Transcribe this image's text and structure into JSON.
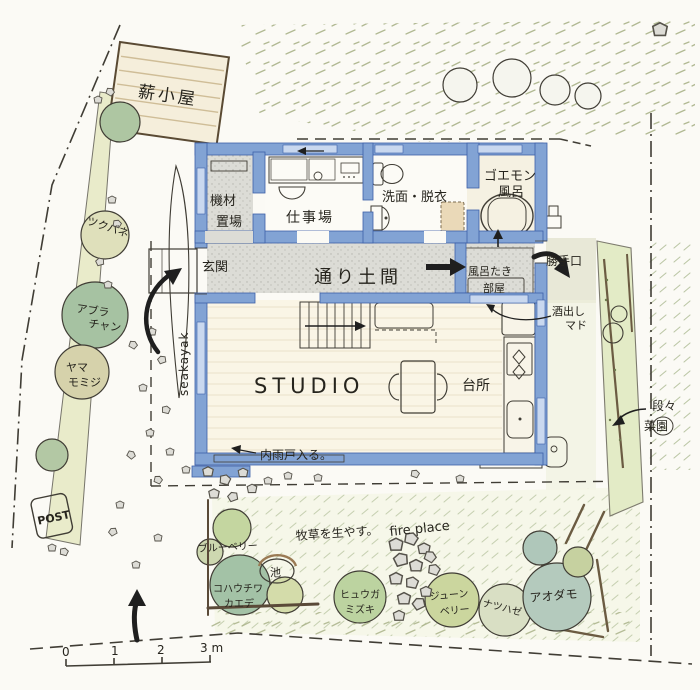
{
  "building": {
    "woodshed": "薪小屋",
    "equipment_room": {
      "l1": "機材",
      "l2": "置場"
    },
    "workshop": "仕事場",
    "washroom": "洗面・脱衣",
    "goemon_bath": {
      "l1": "ゴエモン",
      "l2": "風呂"
    },
    "entrance": "玄関",
    "doma_corridor": "通り土間",
    "bath_boiler_room": {
      "l1": "風呂たき",
      "l2": "部屋"
    },
    "back_door": "勝手口",
    "sake_window": {
      "l1": "酒出し",
      "l2": "マド"
    },
    "studio": "STUDIO",
    "kitchen": "台所",
    "inner_shutter_note": "内雨戸入る。"
  },
  "garden": {
    "sea_kayak": "seakayak",
    "post": "POST",
    "terraced_beds": {
      "l1": "段々",
      "l2": "菜園"
    },
    "meadow_note": "牧草を生やす。",
    "fire_place": "fire place",
    "pond": "池"
  },
  "plants": {
    "tsukubane": "ツクバネ",
    "aburachan": {
      "l1": "アブラ",
      "l2": "チャン"
    },
    "yama_momiji": {
      "l1": "ヤマ",
      "l2": "モミジ"
    },
    "blueberry": "ブルーベリー",
    "kohauchiwa_kaede": {
      "l1": "コハウチワ",
      "l2": "カエデ"
    },
    "hyuga_mizuki": {
      "l1": "ヒュウガ",
      "l2": "ミズキ"
    },
    "june_berry": {
      "l1": "ジューン",
      "l2": "ベリー"
    },
    "natsuhaze": "ナツハゼ",
    "aodamo": "アオダモ"
  },
  "scale_bar": {
    "t0": "0",
    "t1": "1",
    "t2": "2",
    "t3": "3 m"
  },
  "palette": {
    "wall_blue": "#82a3d4",
    "window_blue": "#c9d8ef",
    "pencil": "#403d35",
    "doma_gray": "#dcdcd6",
    "wood_floor": "#faf5e6",
    "counter_tan": "#e3cda4",
    "pond_blue": "#a9cbe3",
    "grass_green": "#a9b288"
  }
}
